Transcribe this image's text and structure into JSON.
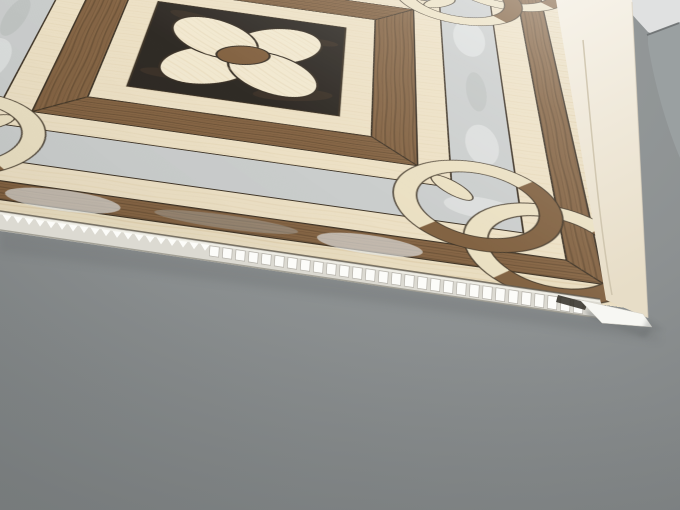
{
  "scene": {
    "subject": "decorative-pvc-ceiling-panel",
    "panel_finish": "marble-and-walnut-inlay-print",
    "edge_type": "hollow-core-cells-with-tongue-lip",
    "setting": "gray-table-surface"
  },
  "colors": {
    "background_gray": "#8e9293",
    "background_dark": "#767b7c",
    "background_light": "#9da1a2",
    "bg_object_gray": "#9aa0a1",
    "bg_object_light": "#e0e1e1",
    "cream_margin": "#e9dcbe",
    "cream_band": "#ecdfc2",
    "travertine_streak": "#d8c49c",
    "wood": "#7d5b39",
    "wood_dark": "#4e3720",
    "wood_light": "#8d6b45",
    "outline": "#33281a",
    "gray_marble": "#c8cbca",
    "marble_light": "#e4e6e5",
    "marble_dark": "#adb1b0",
    "black_marble": "#221d17",
    "black_marble_vein": "#503a25",
    "petal": "#f1e7cd",
    "flower_center": "#7a5734",
    "ring_wood": "#7b5a38",
    "ring_cream": "#eadfc0",
    "edge_face_light": "#f7f3ea",
    "edge_face": "#e7ddc7",
    "core_base": "#dcdad2",
    "core_cell": "#fcfcf9",
    "core_gap": "#b5b2aa",
    "lip_white": "#f7f7f3",
    "shadow": "#6f7374",
    "notch_dark": "#2f2b25"
  }
}
